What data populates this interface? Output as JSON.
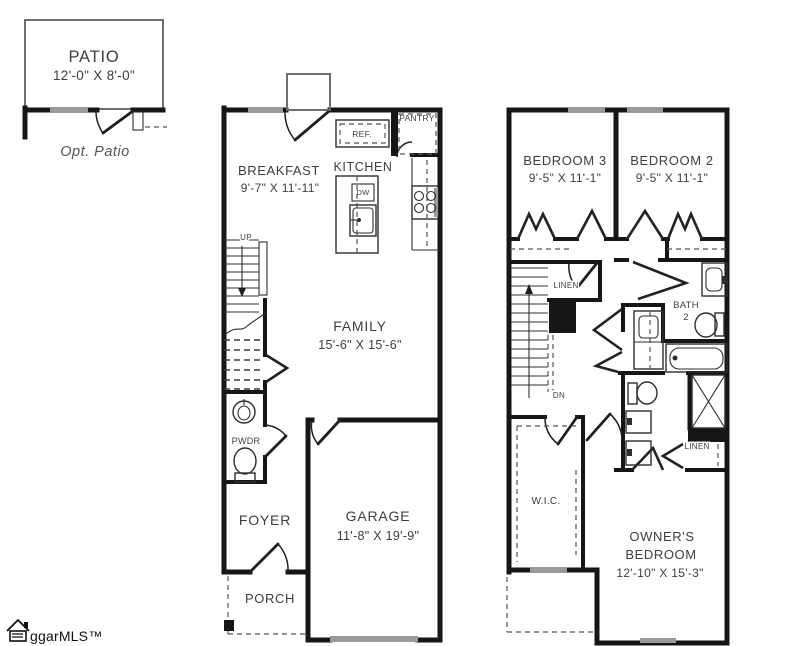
{
  "patio": {
    "label": "PATIO",
    "dims": "12'-0\" X 8'-0\"",
    "caption": "Opt. Patio"
  },
  "floor1": {
    "breakfast_label": "BREAKFAST",
    "breakfast_dims": "9'-7\" X 11'-11\"",
    "kitchen_label": "KITCHEN",
    "ref_label": "REF.",
    "pantry_label": "PANTRY",
    "dw_label": "DW",
    "up_label": "UP",
    "family_label": "FAMILY",
    "family_dims": "15'-6\" X 15'-6\"",
    "powder_label": "PWDR",
    "foyer_label": "FOYER",
    "garage_label": "GARAGE",
    "garage_dims": "11'-8\" X 19'-9\"",
    "porch_label": "PORCH"
  },
  "floor2": {
    "bedroom3_label": "BEDROOM 3",
    "bedroom3_dims": "9'-5\" X 11'-1\"",
    "bedroom2_label": "BEDROOM 2",
    "bedroom2_dims": "9'-5\" X 11'-1\"",
    "linen_upper_label": "LINEN",
    "bath2_line1": "BATH",
    "bath2_line2": "2",
    "dn_label": "DN",
    "wic_label": "W.I.C.",
    "linen_lower_label": "LINEN",
    "owners_line1": "OWNER'S",
    "owners_line2": "BEDROOM",
    "owners_dims": "12'-10\" X 15'-3\""
  },
  "watermark": {
    "brand": "ggarMLS™"
  },
  "colors": {
    "wall": "#161616",
    "window": "#9a9a9a",
    "fixture": "#2e2e2e",
    "text": "#3e3e3e",
    "background": "#ffffff"
  }
}
